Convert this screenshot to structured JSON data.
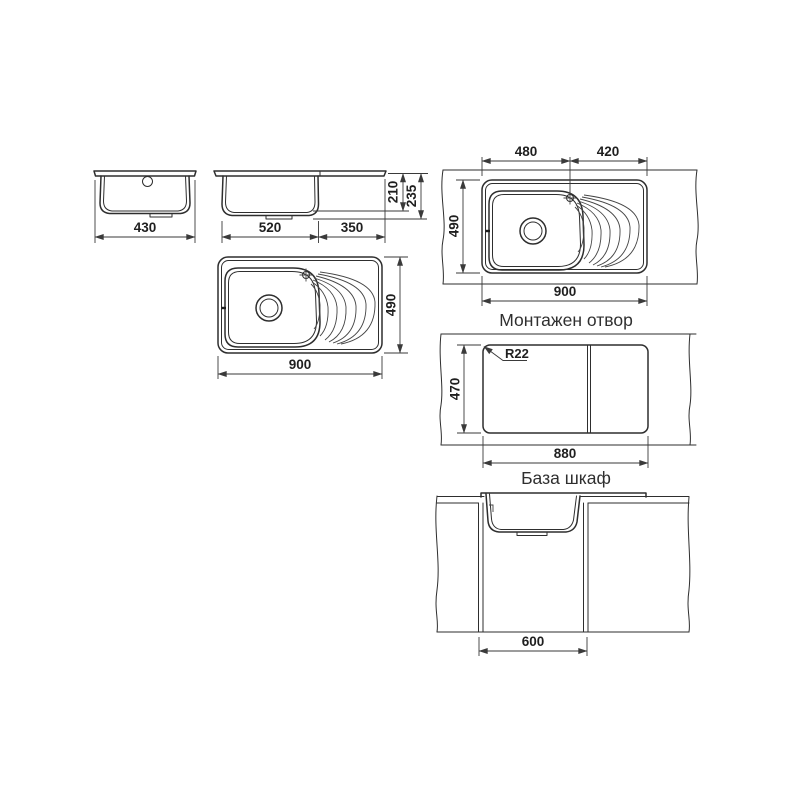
{
  "page": {
    "background_color": "#ffffff"
  },
  "drawing": {
    "line_color": "#2e2e2e",
    "dimension_color": "#3a3a3a",
    "captions": {
      "mounting_hole": "Монтажен отвор",
      "base_cabinet": "База шкаф"
    },
    "front_view": {
      "overall_width": "430"
    },
    "side_view": {
      "bowl_length": "520",
      "drainer_length": "350",
      "bowl_depth": "210",
      "overall_depth": "235"
    },
    "plan_view": {
      "overall_length": "900",
      "overall_width": "490"
    },
    "countertop_view": {
      "bowl_section": "480",
      "drainer_section": "420",
      "overall_width": "490",
      "overall_length": "900"
    },
    "cutout_view": {
      "corner_radius": "R22",
      "cutout_width": "470",
      "cutout_length": "880"
    },
    "cabinet_view": {
      "cabinet_width": "600"
    }
  }
}
